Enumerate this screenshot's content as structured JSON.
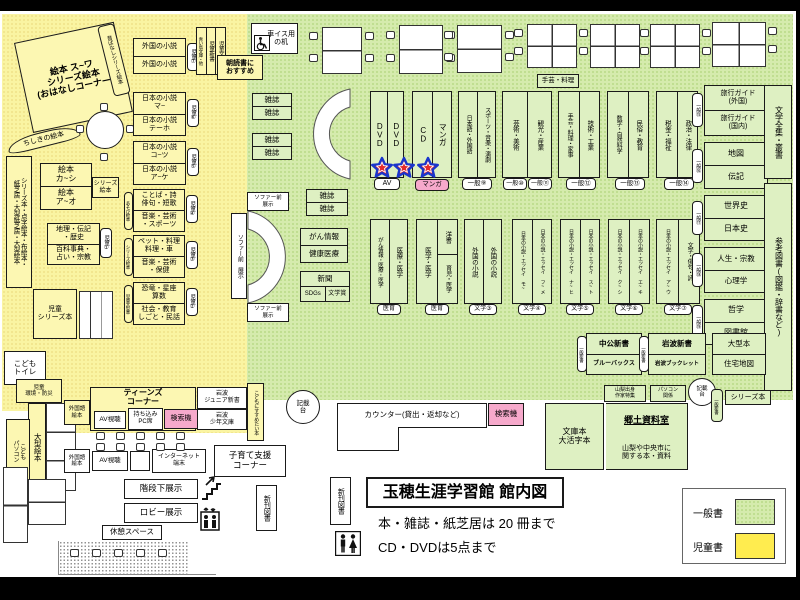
{
  "title": {
    "main": "玉穂生涯学習館 館内図",
    "note1": "本・雑誌・紙芝居は 20 冊まで",
    "note2": "CD・DVDは5点まで"
  },
  "legend": {
    "general": "一般書",
    "children": "児童書"
  },
  "colors": {
    "general_green": "#d5ebad",
    "children_yellow": "#faf4a2",
    "legend_yellow": "#ffec4f",
    "pink": "#f6a9cb",
    "star_red": "#e62b2b",
    "star_blue": "#1a35cc"
  },
  "icons": {
    "wheelchair": "wheelchair-icon",
    "stairs": "stairs-icon",
    "elevator": "elevator-icon",
    "restroom": "restroom-icon",
    "star": "star-icon"
  },
  "labels": {
    "ohanashi": "絵本 ス~ワ\nシリーズ絵本\n(おはなしコーナー)",
    "mukashi": "昔ばなしシリーズ絵本",
    "chishiki": "ちしきの絵本",
    "s7a": "外国の小説",
    "s7b": "外国の小説",
    "p7": "児童⑦",
    "s6a": "日本の小説\nマ~",
    "s6b": "日本の小説\nテーホ",
    "p6": "児童⑥",
    "s5a": "日本の小説\nコ~ツ",
    "s5b": "日本の小説\nア~ケ",
    "p5": "児童⑤",
    "s4a": "ことば・詩\n俳句・短歌",
    "s4b": "音楽・芸術\n・スポーツ",
    "p4": "児童④",
    "p4l": "あそび絵本",
    "s3a": "ペット・料理\n料理・車",
    "s3b": "音楽・芸術\n・保健",
    "p3": "児童③",
    "p3l": "シリーズ絵本",
    "s2a": "恐竜・星座\n算数",
    "s2b": "社会・教育\nしごと・民話",
    "p2": "児童②",
    "p2l": "児童大型本",
    "s1a": "地理・伝記\n・歴史",
    "s1b": "百科事典・\n占い・宗教",
    "p1": "児童①",
    "ehon_ka": "絵本\nカ~シ",
    "ehon_a": "絵本\nア~オ",
    "series_ehon": "シリーズ\n絵本",
    "jidobunko": "児童文庫",
    "jidoshinsho": "児童新書",
    "aoitori": "青い鳥文庫・他",
    "asadoku": "朝読書に\nおすすめ",
    "kamishibai": "シリーズ本・点字絵本・布絵本・\n紙芝居・大型紙芝居・大型絵本",
    "jido_series": "児童\nシリーズ本",
    "toilet": "こども\nトイレ",
    "kankyo": "児童\n環境・防災",
    "ogata_ehon": "大型絵本",
    "kodomo_pc": "こども\nパソコン",
    "gaikokugo": "外国語\n絵本",
    "teens": "ティーンズ\nコーナー",
    "av": "AV視聴",
    "pc_seki": "持ち込み\nPC席",
    "kensaku": "検索機",
    "iwanami_jr": "岩波\nジュニア新書",
    "iwanami_sho": "岩波\n少年文庫",
    "susume": "こどもにすすめたい本",
    "internet": "インターネット\n端末",
    "kosodate": "子育て支援\nコーナー",
    "kaidan": "階段下展示",
    "lobby": "ロビー展示",
    "kyukei": "休憩スペース",
    "shinkan": "新刊図書",
    "kurumaisu": "車イス用\nの机",
    "zasshi": "雑誌",
    "sofa_v": "ソファー前 展示",
    "sofa_h": "ソファー前\n展示",
    "dvd": "DVD",
    "cd": "CD",
    "manga": "マンガ",
    "av_label": "AV",
    "manga_label": "マンガ",
    "g9a": "日本語・外国語",
    "g9b": "スポーツ・音楽・演劇",
    "g9": "一般⑨",
    "g10a": "芸術・美術",
    "g10b": "観光・産業",
    "g10": "一般⑩",
    "g11": "一般⑪",
    "shugei": "手芸・料理",
    "g12a": "手芸・料理・家事",
    "g12b": "技術・工業",
    "g12": "一般⑫",
    "g13a": "数学・自然科学",
    "g13b": "民俗・教育",
    "g13": "一般⑬",
    "g14a": "税金・福祉",
    "g14b": "政治・法律",
    "g14": "一般⑭",
    "gan1": "がん情報",
    "gan2": "健康医療",
    "shinbun": "新聞",
    "sdgs": "SDGs",
    "bungakusho": "文学賞",
    "med1a": "がん情報・医療・医学",
    "med1b": "医療・医学",
    "med_label": "医育",
    "med2a": "医学・医学",
    "med2b1": "洋書",
    "med2b2": "育児・医学",
    "lit3a": "外国の小説",
    "lit3b": "外国の小説",
    "lit3": "文学③",
    "lit4a": "日本の小説・エッセイ モ~",
    "lit4b": "日本の小説・エッセイ フ~メ",
    "lit4": "文学④",
    "lit5a": "日本の小説・エッセイ ナ~ヒ",
    "lit5b": "日本の小説・エッセイ ス~ト",
    "lit5": "文学⑤",
    "lit6a": "日本の小説・エッセイ ク~シ",
    "lit6b": "日本の小説・エッセイ エ~キ",
    "lit6": "文学⑥",
    "lit7a": "日本の小説・エッセイ ア~ウ",
    "lit7b": "文学・俳句・詩",
    "lit7": "文学⑦",
    "g15a": "旅行ガイド\n(外国)",
    "g15b": "旅行ガイド\n(国内)",
    "g15": "一般⑮",
    "g16a": "地図",
    "g16b": "伝記",
    "g16": "一般⑯",
    "g17a": "世界史",
    "g17b": "日本史",
    "g17": "一般⑰",
    "g18a": "人生・宗教",
    "g18b": "心理学",
    "g18": "一般⑱",
    "g19a": "哲学",
    "g19b": "図書館",
    "g19": "一般⑲",
    "zenshu": "文学全集・叢書",
    "sanko": "参考図書(図鑑・辞書など)",
    "chuko1": "中公新書",
    "chuko2": "ブルーバックス",
    "ippan_shinsho": "一般新書",
    "iwanami1": "岩波新書",
    "iwanami2": "岩波ブックレット",
    "ogata_bon": "大型本",
    "jutaku": "住宅地図",
    "counter": "カウンター(貸出・返却など)",
    "kisaidai": "記載\n台",
    "bunkobon": "文庫本\n大活字本",
    "kyodo_title": "郷土資料室",
    "kyodo_desc": "山梨や中央市に\n関する本・資料",
    "yamanashi": "山梨出身\n作家特集",
    "pc_kankei": "パソコン\n関係",
    "series_bon": "シリーズ本"
  }
}
